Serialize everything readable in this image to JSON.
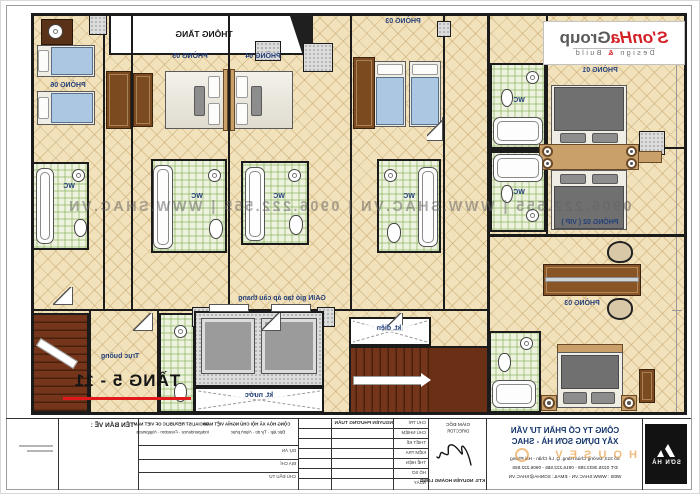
{
  "plan": {
    "floor_range_label": "TẦNG 5 - 11",
    "void_label": "THÔNG TẦNG",
    "pressurization_label": "GAIN gió tạo áp cầu thang",
    "electric_shaft_label": "kt. điện",
    "water_shaft_label": "kt. nước",
    "service_core_label": "Trục buồng",
    "wc_label": "WC",
    "rooms": {
      "room01": "PHÒNG 01",
      "room02": "PHÒNG 02 ( VIP )",
      "room03_upper": "PHÒNG 03",
      "room03_lower": "PHÒNG 03",
      "room04": "PHÒNG 04",
      "room05": "PHÒNG 05",
      "room06": "PHÒNG 06"
    }
  },
  "watermark": {
    "strip": "0906.222.555   |   WWW.SHAC.VN   |   0906.222.555   |   WWW.SHAC.VN",
    "orange": "H O U S E V"
  },
  "brand_logo": {
    "red": "S'onHa",
    "gray": "Group",
    "design": "Design",
    "amp": "&",
    "build": "Build"
  },
  "titleblock": {
    "corner_logo_text": "SƠN HÀ",
    "company_line1": "CÔNG TY CỔ PHẦN TƯ VẤN",
    "company_line2": "XÂY DỰNG SƠN HÀ - SHAC",
    "company_line3": "Số 313, Đường Chùa Hàng, Q. Lê Chân - Hải Phòng",
    "company_line4": "ĐT: 0225.3833.288 - 0916.222.555 - 0906.222.555",
    "company_line5": "WEB : WWW.SHAC.VN - EMAIL: SONHA@SHAC.VN",
    "director_label": "GIÁM ĐỐC",
    "director_label_en": "DIRECTOR",
    "architect_name": "KTS. NGUYỄN HOÀNG LONG",
    "row_labels": [
      "CHỦ TRÌ",
      "CHỦ NHIỆM",
      "THIẾT KẾ",
      "KIỂM TRA",
      "THỂ HIỆN",
      "HỒ SƠ",
      "NGÀY"
    ],
    "row_value_top": "NGUYỄN PHƯƠNG TUẤN",
    "republic_vn1": "CỘNG HÒA XÃ HỘI CHỦ NGHĨA VIỆT NAM",
    "republic_vn2": "Độc lập - Tự do - Hạnh phúc",
    "republic_en1": "SOCIALIST REPUBLIC OF VIET NAM",
    "republic_en2": "Independence - Freedom - Happiness",
    "project_label": "DỰ ÁN",
    "location_label": "ĐỊA CHỈ",
    "investor_label": "CHỦ ĐẦU TƯ",
    "drawing_name_label": "TÊN BẢN VẼ :"
  }
}
